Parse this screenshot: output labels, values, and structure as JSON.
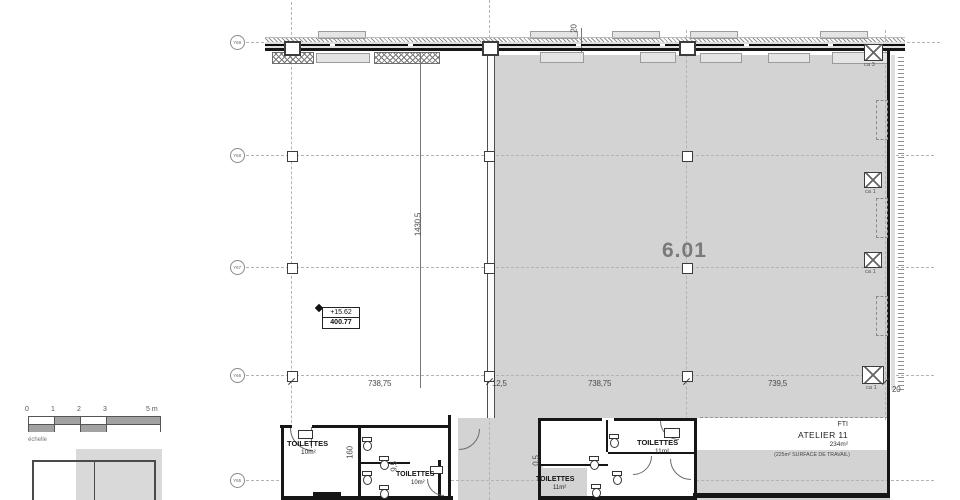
{
  "drawing": {
    "main_room_number": "6.01",
    "atelier": {
      "org": "FTI",
      "name": "ATELIER 11",
      "area": "234m²",
      "note": "(225m² SURFACE DE TRAVAIL)"
    },
    "toilettes": [
      {
        "name": "TOILETTES",
        "area": "10m²"
      },
      {
        "name": "TOILETTES",
        "area": "10m²"
      },
      {
        "name": "TOILETTES",
        "area": "11m²"
      },
      {
        "name": "TOILETTES",
        "area": "11m²"
      }
    ],
    "elevation": {
      "relative_level": "+15.62",
      "absolute_level": "400.77"
    }
  },
  "grid_rows": [
    {
      "label": "Y69"
    },
    {
      "label": "Y68"
    },
    {
      "label": "Y67"
    },
    {
      "label": "Y66"
    },
    {
      "label": "Y65"
    }
  ],
  "column_tags": [
    {
      "label": "ca 3"
    },
    {
      "label": "ca 1"
    },
    {
      "label": "ca 1"
    },
    {
      "label": "ca 1"
    }
  ],
  "dimensions": {
    "top_offset": "20",
    "vertical_total": "1430,5",
    "bay_1": "738,75",
    "wall_gap": "12,5",
    "bay_2": "738,75",
    "bay_3": "739,5",
    "right_offset": "20",
    "detail_160": "160",
    "detail_9_5": "9,5",
    "detail_0_5": "0,5"
  },
  "scalebar": {
    "ticks": [
      {
        "t": "0"
      },
      {
        "t": "1"
      },
      {
        "t": "2"
      },
      {
        "t": "3"
      },
      {
        "t": "5 m"
      }
    ],
    "caption": "échelle"
  },
  "colors": {
    "room_fill": "#d3d3d3",
    "wall": "#161616",
    "gridline": "#b3b3b3",
    "big_label": "#7a7a7a"
  }
}
